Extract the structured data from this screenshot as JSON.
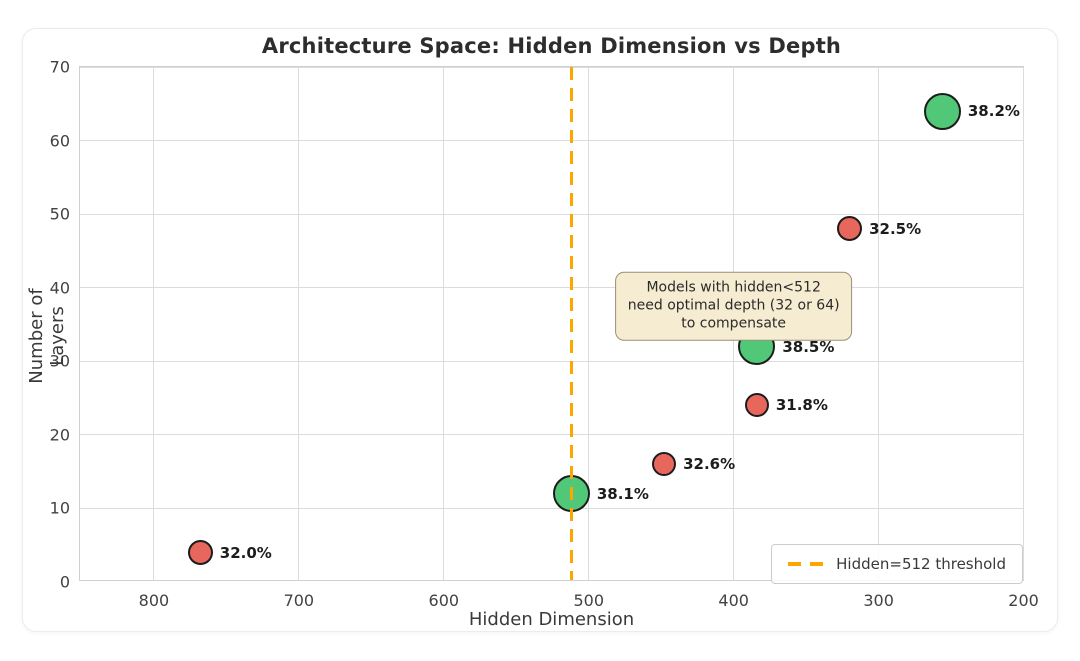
{
  "chart_data": {
    "type": "scatter",
    "title": "Architecture Space: Hidden Dimension vs Depth",
    "xlabel": "Hidden Dimension",
    "ylabel": "Number of Layers",
    "x_axis_reversed": true,
    "xlim": [
      851,
      199
    ],
    "ylim": [
      0,
      70
    ],
    "x_ticks": [
      800,
      700,
      600,
      500,
      400,
      300,
      200
    ],
    "y_ticks": [
      0,
      10,
      20,
      30,
      40,
      50,
      60,
      70
    ],
    "grid": true,
    "points": [
      {
        "hidden_dim": 256,
        "layers": 64,
        "accuracy_label": "38.2%",
        "series": "optimal_depth",
        "marker_diameter_px": 37
      },
      {
        "hidden_dim": 320,
        "layers": 48,
        "accuracy_label": "32.5%",
        "series": "suboptimal_depth",
        "marker_diameter_px": 25
      },
      {
        "hidden_dim": 384,
        "layers": 32,
        "accuracy_label": "38.5%",
        "series": "optimal_depth",
        "marker_diameter_px": 37
      },
      {
        "hidden_dim": 384,
        "layers": 24,
        "accuracy_label": "31.8%",
        "series": "suboptimal_depth",
        "marker_diameter_px": 24
      },
      {
        "hidden_dim": 448,
        "layers": 16,
        "accuracy_label": "32.6%",
        "series": "suboptimal_depth",
        "marker_diameter_px": 24
      },
      {
        "hidden_dim": 512,
        "layers": 12,
        "accuracy_label": "38.1%",
        "series": "optimal_depth",
        "marker_diameter_px": 37
      },
      {
        "hidden_dim": 768,
        "layers": 4,
        "accuracy_label": "32.0%",
        "series": "suboptimal_depth",
        "marker_diameter_px": 25
      }
    ],
    "threshold_line": {
      "x": 512,
      "style": "dashed",
      "color": "#ffa500"
    },
    "annotation": {
      "text": "Models with hidden<512\nneed optimal depth (32 or 64)\nto compensate",
      "x": 400,
      "y": 37.5,
      "bg": "#f5ecd2",
      "border": "#9a8f74"
    },
    "legend": {
      "position": "lower right",
      "entries": [
        {
          "label": "Hidden=512 threshold",
          "line_color": "#ffa500",
          "line_style": "dashed"
        }
      ]
    },
    "colors": {
      "optimal_depth": "#50c878",
      "suboptimal_depth": "#e8675d",
      "marker_edge": "#1c1c1c",
      "grid": "#dcdcdc",
      "plot_border": "#cfcfcf",
      "threshold": "#ffa500"
    }
  }
}
